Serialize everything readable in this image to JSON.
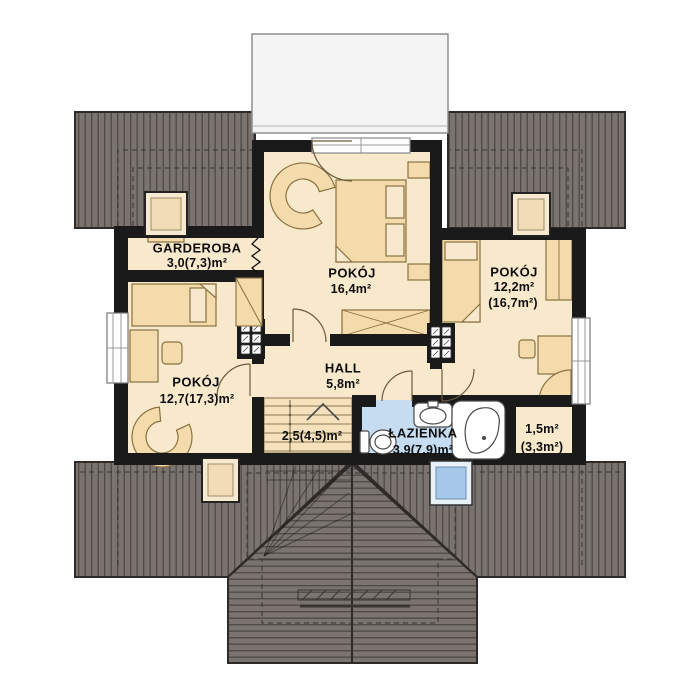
{
  "colors": {
    "wall": "#1a1a1a",
    "floor": "#f9e9cc",
    "furniture": "#f3dbab",
    "roof_base": "#7a7370",
    "roof_stripe": "#514c49",
    "bathroom_floor": "#c6dcf0",
    "skylight_glass": "#a6c8e8",
    "balcony": "#f4f4f4"
  },
  "rooms": {
    "garderoba": {
      "name": "GARDEROBA",
      "area": "3,0(7,3)m²"
    },
    "pokoj_center": {
      "name": "POKÓJ",
      "area": "16,4m²"
    },
    "pokoj_right": {
      "name": "POKÓJ",
      "area": "12,2m²",
      "area_total": "(16,7m²)"
    },
    "pokoj_left": {
      "name": "POKÓJ",
      "area": "12,7(17,3)m²"
    },
    "hall": {
      "name": "HALL",
      "area": "5,8m²"
    },
    "stairs": {
      "area": "2,5(4,5)m²"
    },
    "lazienka": {
      "name": "ŁAZIENKA",
      "area": "3,9(7,9)m²"
    },
    "storage": {
      "area": "1,5m²",
      "area_total": "(3,3m²)"
    }
  }
}
